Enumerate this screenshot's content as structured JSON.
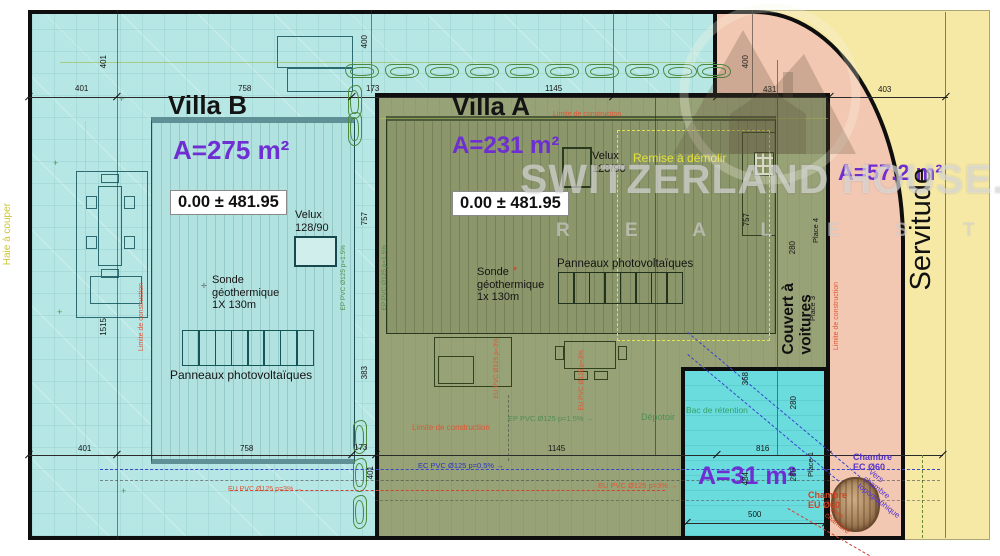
{
  "villa_b": {
    "title": "Villa B",
    "area": "A=275 m²",
    "elevation": "0.00 ± 481.95",
    "velux": "Velux\n128/90",
    "sonde": "Sonde\ngéothermique\n1X 130m",
    "panneaux": "Panneaux photovoltaïques"
  },
  "villa_a": {
    "title": "Villa A",
    "area": "A=231 m²",
    "elevation": "0.00 ± 481.95",
    "velux": "Velux\n128/90",
    "sonde": "Sonde\ngéothermique\n1x 130m",
    "panneaux": "Panneaux photovoltaïques",
    "remise": "Remise à démolir",
    "depotoir": "Dépotoir"
  },
  "servitude": {
    "label": "Servitude",
    "area": "A=57.2 m²"
  },
  "carport": {
    "label": "Couvert à\nvoitures",
    "area": "A=31 m²",
    "bac": "Bac de rétention",
    "place1": "Place 1",
    "place3": "Place 3",
    "place4": "Place 4"
  },
  "chambers": {
    "ec": "Chambre\nEC Ø60",
    "eu": "Chambre\nEU Ø60",
    "vers_purple": "Vers\nchambre\ntopographique",
    "vers_red": "Vers\nchambre"
  },
  "pipes": {
    "ec": "EC PVC Ø125 p=0.5% →",
    "eu": "EU PVC Ø125 p=3% →",
    "ep": "EP PVC Ø125 p=1.5% →",
    "eu_v": "EU PVC Ø125 p=3%",
    "ep_v": "EP PVC Ø125 p=1.5%"
  },
  "annotations": {
    "haie": "Haie à couper",
    "limite": "Limite de construction"
  },
  "watermark": {
    "brand": "SWITZERLAND HOUSE.CH",
    "tagline": "R E A L   E S T A T E"
  },
  "dims": {
    "d400": "400",
    "d401": "401",
    "d758": "758",
    "d173": "173",
    "d1145": "1145",
    "d431": "431",
    "d403": "403",
    "d1515": "1515",
    "d757": "757",
    "d383": "383",
    "d280": "280",
    "d368": "368",
    "d816": "816",
    "d500": "500",
    "d484": "484"
  }
}
